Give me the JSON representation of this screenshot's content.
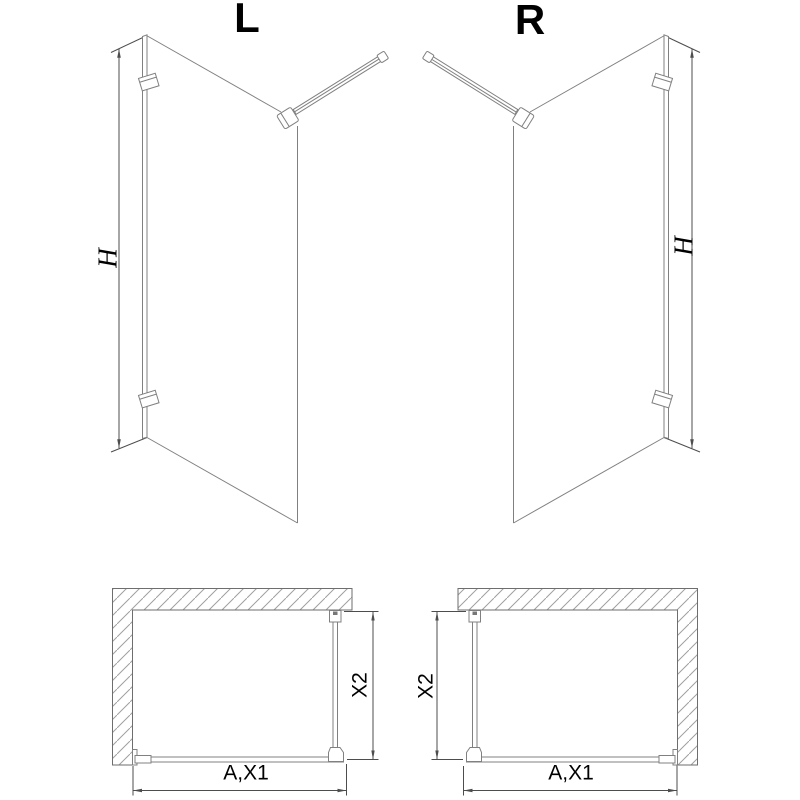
{
  "views": {
    "left_3d": {
      "label": "L",
      "height_dim": "H"
    },
    "right_3d": {
      "label": "R",
      "height_dim": "H"
    },
    "left_plan": {
      "depth_dim": "X2",
      "width_dim": "A,X1"
    },
    "right_plan": {
      "depth_dim": "X2",
      "width_dim": "A,X1"
    }
  },
  "colors": {
    "background": "#ffffff",
    "drawing_line": "#808080",
    "wall_line": "#6e6e6e",
    "hatch": "#a0a0a0",
    "dimension_line": "#4d4d4d",
    "text": "#000000"
  }
}
